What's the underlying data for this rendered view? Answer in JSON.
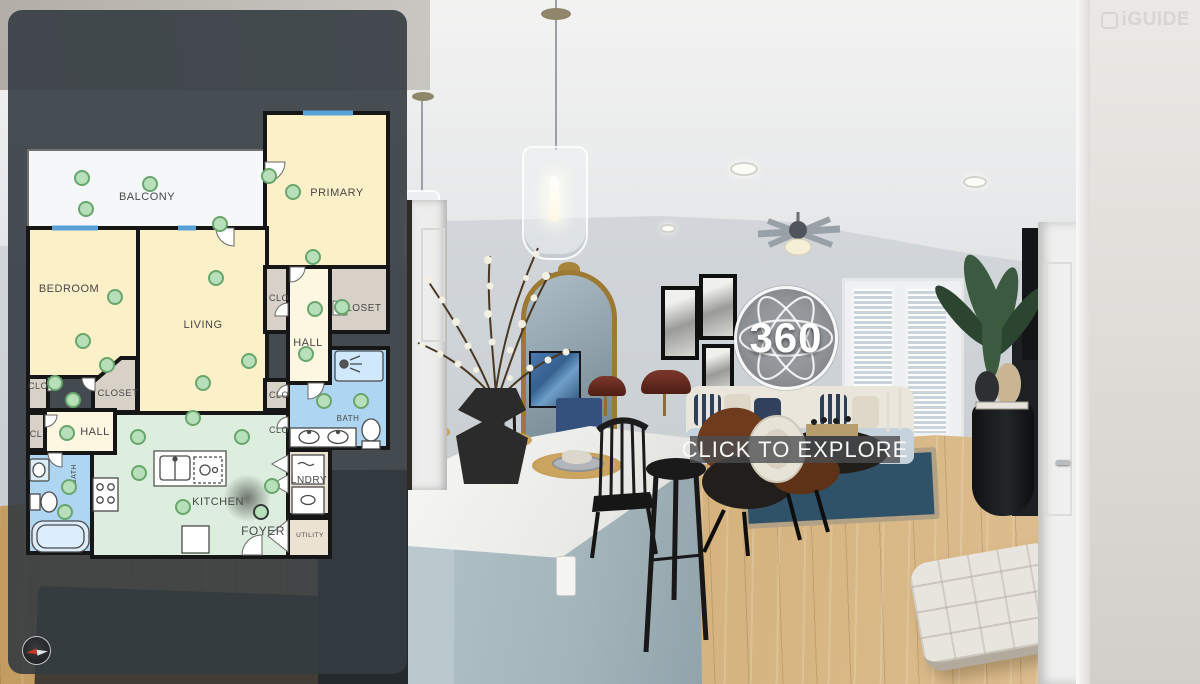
{
  "header": {
    "brand": "iGUIDE"
  },
  "viewer": {
    "badge_label": "360",
    "cta_label": "CLICK TO EXPLORE"
  },
  "colors": {
    "panel": "rgba(52,60,65,0.9)",
    "room_yellow": "#fcf0c8",
    "room_cream": "#fdf6e1",
    "room_tan": "#d8d1c7",
    "room_tan_light": "#ece2d2",
    "room_blue": "#aed6f2",
    "room_mint": "#ddeede",
    "balcony_white": "#f5f7f9",
    "wall": "#161616",
    "window_blue": "#58a0d8",
    "dot_fill": "#b7dfb9",
    "dot_stroke": "#69a66d"
  },
  "floor_plan": {
    "rooms": [
      {
        "name": "balcony",
        "shape": "rect",
        "x": 28,
        "y": 150,
        "w": 237,
        "h": 78,
        "fill": "#f5f7f9",
        "stroke": "#6f6f6f",
        "sw": 2
      },
      {
        "name": "primary-bedroom",
        "shape": "rect",
        "x": 265,
        "y": 113,
        "w": 123,
        "h": 154,
        "fill": "#fcf0c8",
        "stroke": "#161616",
        "sw": 4
      },
      {
        "name": "bedroom",
        "shape": "rect",
        "x": 28,
        "y": 228,
        "w": 110,
        "h": 149,
        "fill": "#fcf0c8",
        "stroke": "#161616",
        "sw": 4
      },
      {
        "name": "living-room",
        "shape": "rect",
        "x": 138,
        "y": 228,
        "w": 129,
        "h": 187,
        "fill": "#fcf0c8",
        "stroke": "#161616",
        "sw": 4
      },
      {
        "name": "hall-right",
        "shape": "rect",
        "x": 288,
        "y": 267,
        "w": 42,
        "h": 116,
        "fill": "#fdf6e1",
        "stroke": "#161616",
        "sw": 4
      },
      {
        "name": "closet-right-small",
        "shape": "rect",
        "x": 265,
        "y": 267,
        "w": 23,
        "h": 65,
        "fill": "#d8d1c7",
        "stroke": "#161616",
        "sw": 4
      },
      {
        "name": "closet-right",
        "shape": "rect",
        "x": 330,
        "y": 267,
        "w": 58,
        "h": 65,
        "fill": "#d8d1c7",
        "stroke": "#161616",
        "sw": 4
      },
      {
        "name": "bath-right",
        "shape": "poly",
        "pts": "330,348 388,348 388,448 288,448 288,383 330,383",
        "fill": "#aed6f2",
        "stroke": "#161616",
        "sw": 4
      },
      {
        "name": "clo-right-1",
        "shape": "rect",
        "x": 265,
        "y": 380,
        "w": 23,
        "h": 30,
        "fill": "#d8d1c7",
        "stroke": "#161616",
        "sw": 4
      },
      {
        "name": "clo-right-2",
        "shape": "rect",
        "x": 265,
        "y": 413,
        "w": 23,
        "h": 34,
        "fill": "#d8d1c7",
        "stroke": "#161616",
        "sw": 4
      },
      {
        "name": "clo-left",
        "shape": "rect",
        "x": 28,
        "y": 377,
        "w": 20,
        "h": 33,
        "fill": "#d8d1c7",
        "stroke": "#161616",
        "sw": 4
      },
      {
        "name": "closet-left",
        "shape": "poly",
        "pts": "121,358 137,358 137,412 93,412 93,382",
        "fill": "#d8d1c7",
        "stroke": "#161616",
        "sw": 4
      },
      {
        "name": "cl",
        "shape": "rect",
        "x": 28,
        "y": 413,
        "w": 17,
        "h": 37,
        "fill": "#d8d1c7",
        "stroke": "#161616",
        "sw": 4
      },
      {
        "name": "hall-left",
        "shape": "rect",
        "x": 45,
        "y": 410,
        "w": 70,
        "h": 43,
        "fill": "#fdf6e1",
        "stroke": "#161616",
        "sw": 4
      },
      {
        "name": "bath-left",
        "shape": "rect",
        "x": 28,
        "y": 453,
        "w": 64,
        "h": 100,
        "fill": "#aed6f2",
        "stroke": "#161616",
        "sw": 4
      },
      {
        "name": "kitchen",
        "shape": "poly",
        "pts": "115,413 288,413 288,557 92,557 92,453 115,453",
        "fill": "#ddeede",
        "stroke": "#161616",
        "sw": 4
      },
      {
        "name": "laundry",
        "shape": "rect",
        "x": 288,
        "y": 450,
        "w": 42,
        "h": 65,
        "fill": "#ece2d2",
        "stroke": "#161616",
        "sw": 4
      },
      {
        "name": "utility",
        "shape": "rect",
        "x": 288,
        "y": 518,
        "w": 42,
        "h": 39,
        "fill": "#ece2d2",
        "stroke": "#161616",
        "sw": 4
      }
    ],
    "labels": [
      {
        "t": "BALCONY",
        "x": 147,
        "y": 200,
        "s": 11
      },
      {
        "t": "PRIMARY",
        "x": 337,
        "y": 196,
        "s": 11
      },
      {
        "t": "BEDROOM",
        "x": 69,
        "y": 292,
        "s": 11
      },
      {
        "t": "LIVING",
        "x": 203,
        "y": 328,
        "s": 11
      },
      {
        "t": "CLO",
        "x": 279,
        "y": 301,
        "s": 9
      },
      {
        "t": "CLOSET",
        "x": 360,
        "y": 311,
        "s": 10
      },
      {
        "t": "HALL",
        "x": 308,
        "y": 346,
        "s": 11
      },
      {
        "t": "BATH",
        "x": 348,
        "y": 421,
        "s": 8
      },
      {
        "t": "CLO",
        "x": 279,
        "y": 398,
        "s": 9
      },
      {
        "t": "CLO",
        "x": 279,
        "y": 433,
        "s": 9
      },
      {
        "t": "CLO",
        "x": 38,
        "y": 389,
        "s": 9
      },
      {
        "t": "CLOSET",
        "x": 118,
        "y": 396,
        "s": 9.5
      },
      {
        "t": "CL",
        "x": 36,
        "y": 437,
        "s": 9
      },
      {
        "t": "HALL",
        "x": 95,
        "y": 435,
        "s": 11
      },
      {
        "t": "BATH",
        "x": 76,
        "y": 474,
        "s": 7,
        "r": -90
      },
      {
        "t": "KITCHEN",
        "x": 218,
        "y": 505,
        "s": 11
      },
      {
        "t": "FOYER",
        "x": 263,
        "y": 535,
        "s": 12,
        "c": "#8f8f8f"
      },
      {
        "t": "LNDRY",
        "x": 309,
        "y": 483,
        "s": 10
      },
      {
        "t": "UTILITY",
        "x": 310,
        "y": 537,
        "s": 6.5
      }
    ],
    "windows": [
      [
        52,
        228,
        98,
        228
      ],
      [
        178,
        228,
        196,
        228
      ],
      [
        303,
        113,
        353,
        113
      ]
    ],
    "doors": [
      {
        "x": 234,
        "y": 228,
        "r": 90,
        "s": 18
      },
      {
        "x": 265,
        "y": 162,
        "r": 0,
        "s": 20
      },
      {
        "x": 290,
        "y": 267,
        "r": 0,
        "s": 15
      },
      {
        "x": 288,
        "y": 316,
        "r": 180,
        "s": 13
      },
      {
        "x": 333,
        "y": 315,
        "r": -90,
        "s": 14
      },
      {
        "x": 308,
        "y": 383,
        "r": 0,
        "s": 16
      },
      {
        "x": 48,
        "y": 378,
        "r": 0,
        "s": 13
      },
      {
        "x": 95,
        "y": 378,
        "r": 90,
        "s": 13
      },
      {
        "x": 45,
        "y": 415,
        "r": 0,
        "s": 12
      },
      {
        "x": 62,
        "y": 453,
        "r": 90,
        "s": 14
      },
      {
        "x": 262,
        "y": 555,
        "r": 180,
        "s": 20
      },
      {
        "x": 288,
        "y": 396,
        "r": 180,
        "s": 11
      },
      {
        "x": 288,
        "y": 428,
        "r": 180,
        "s": 11
      }
    ],
    "bifolds": [
      [
        288,
        455,
        272,
        464,
        288,
        473
      ],
      [
        288,
        475,
        272,
        484,
        288,
        493
      ],
      [
        288,
        520,
        268,
        536,
        288,
        552
      ]
    ],
    "camera_dots": [
      [
        82,
        178
      ],
      [
        150,
        184
      ],
      [
        86,
        209
      ],
      [
        269,
        176
      ],
      [
        293,
        192
      ],
      [
        220,
        224
      ],
      [
        313,
        257
      ],
      [
        216,
        278
      ],
      [
        115,
        297
      ],
      [
        83,
        341
      ],
      [
        315,
        309
      ],
      [
        342,
        307
      ],
      [
        306,
        354
      ],
      [
        249,
        361
      ],
      [
        203,
        383
      ],
      [
        107,
        365
      ],
      [
        55,
        383
      ],
      [
        73,
        400
      ],
      [
        67,
        433
      ],
      [
        324,
        401
      ],
      [
        361,
        401
      ],
      [
        138,
        437
      ],
      [
        193,
        418
      ],
      [
        242,
        437
      ],
      [
        139,
        473
      ],
      [
        272,
        486
      ],
      [
        183,
        507
      ],
      [
        69,
        487
      ],
      [
        65,
        512
      ],
      [
        261,
        512
      ]
    ],
    "active_dot": [
      261,
      512
    ]
  }
}
